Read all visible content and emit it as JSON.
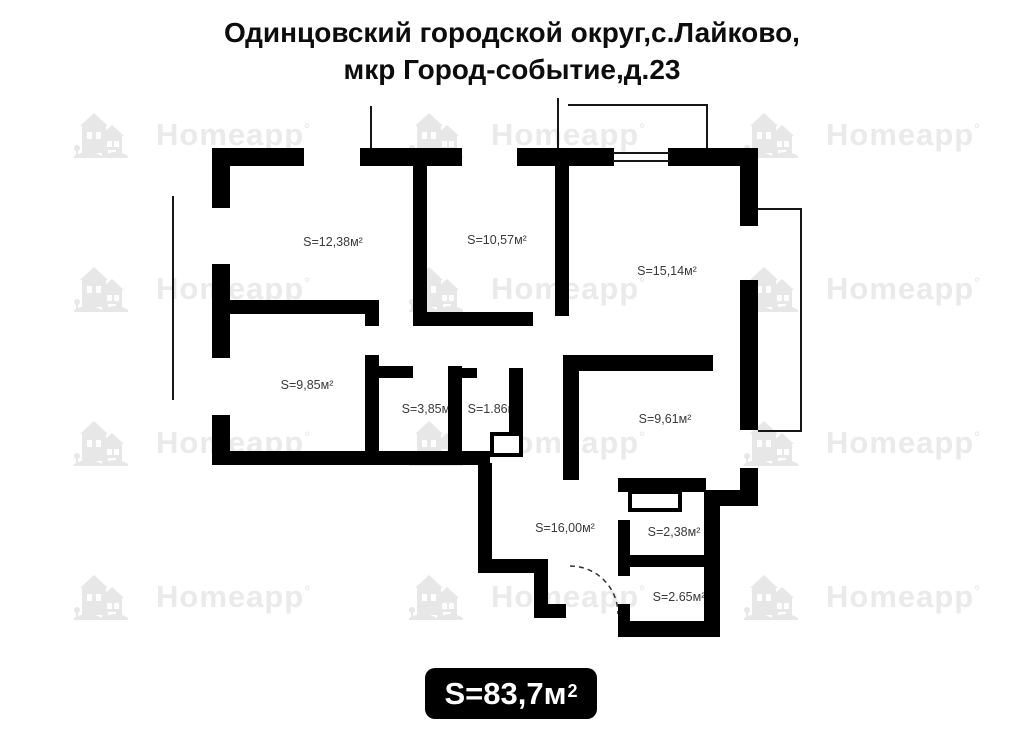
{
  "title": {
    "line1": "Одинцовский городской округ,с.Лайково,",
    "line2": "мкр Город-событие,д.23"
  },
  "rooms": [
    {
      "id": "room-12-38",
      "label": "S=12,38м²"
    },
    {
      "id": "room-10-57",
      "label": "S=10,57м²"
    },
    {
      "id": "room-15-14",
      "label": "S=15,14м²"
    },
    {
      "id": "room-9-85",
      "label": "S=9,85м²"
    },
    {
      "id": "room-3-85",
      "label": "S=3,85м²"
    },
    {
      "id": "room-1-86",
      "label": "S=1.86м²"
    },
    {
      "id": "room-9-61",
      "label": "S=9,61м²"
    },
    {
      "id": "room-16-00",
      "label": "S=16,00м²"
    },
    {
      "id": "room-2-38",
      "label": "S=2,38м²"
    },
    {
      "id": "room-2-65",
      "label": "S=2.65м²"
    }
  ],
  "total": {
    "label": "S=83,7м",
    "sup": "2"
  },
  "watermark": {
    "text": "Homeapp",
    "mark": "°"
  },
  "colors": {
    "wall": "#000000",
    "room_label_text": "#3a3a3a",
    "watermark": "#eaeaea",
    "total_bg": "#000000",
    "total_text": "#ffffff"
  }
}
